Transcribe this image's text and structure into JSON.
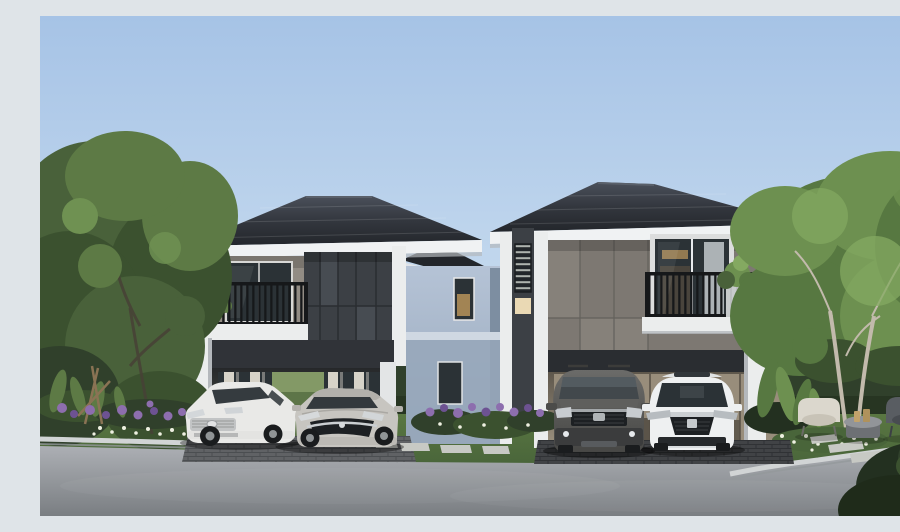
{
  "canvas": {
    "width": 900,
    "height": 500
  },
  "scene": {
    "description": "Daytime architectural rendering of two modern two-storey detached houses with dark hipped tile roofs, charcoal and taupe panelled facades, white trim, balconies with black vertical railings, open double carports with parked cars, landscaped gardens with large trees, hedges, purple and white flower beds, stepping stones, an outdoor seating area with armchairs and a side table, and an asphalt road with concrete kerbs in the foreground.",
    "left_house": {
      "name": "left house",
      "features": [
        "dark hipped tile roof",
        "white fascia",
        "balcony with black vertical railing and plant",
        "charcoal wall panels",
        "glass doors with white curtains",
        "double carport",
        "light blue-grey rear wing with lit window"
      ],
      "cars": [
        {
          "name": "white sedan",
          "color_key": "car_white"
        },
        {
          "name": "silver sedan",
          "color_key": "car_silver"
        }
      ]
    },
    "right_house": {
      "name": "right house",
      "features": [
        "dark hipped tile roof",
        "white fascia",
        "taupe wall panels",
        "large upper window with juliet balcony and potted plant",
        "louvred vent strip with lit panel",
        "double carport with glazed living room behind"
      ],
      "cars": [
        {
          "name": "dark grey suv",
          "color_key": "suv_top"
        },
        {
          "name": "white sedan",
          "color_key": "car_white2"
        }
      ]
    },
    "landscape": {
      "left": [
        "large green tree",
        "clipped hedge",
        "purple flower bed",
        "white ground flowers",
        "staked sapling",
        "tropical foliage"
      ],
      "middle": [
        "purple flower bed between houses",
        "lawn with stepping stones"
      ],
      "right": [
        "large light-green tree with pale trunks",
        "hedge",
        "tropical plants",
        "white flower bed",
        "stepping stone path",
        "dark corner shrub"
      ],
      "background": [
        "neighbouring house rooftops"
      ]
    },
    "furniture": {
      "items": [
        "cream armchair",
        "round side table with candles",
        "dark grey armchair"
      ]
    },
    "road": {
      "type": "asphalt street with concrete kerbs and brick paver driveway aprons"
    }
  },
  "colors": {
    "sky_top": "#a6c3e6",
    "sky_mid": "#c4d9ee",
    "sky_horizon": "#eef2f5",
    "roof_dark": "#23262b",
    "roof_mid": "#33373e",
    "roof_light": "#4a505a",
    "fascia": "#f0f2f3",
    "fascia_shadow": "#b4b8bc",
    "taupe": "#928c84",
    "taupe_dark": "#7d7872",
    "taupe_panel": "#86817a",
    "charcoal": "#3c4045",
    "charcoal_light": "#474c52",
    "charcoal_dark": "#2a2d31",
    "header_dark": "#303338",
    "white_trim": "#ebeded",
    "bluegray_light": "#b5c3d6",
    "bluegray": "#97a7ba",
    "bluegray_dark": "#7d8ea1",
    "glass_dark": "#2b3236",
    "glass_frame": "#dcdddd",
    "curtain": "#d7d3c8",
    "glass_court": "#5d7548",
    "interior_warm": "#988d7b",
    "interior_art": "#c2b399",
    "interior_dark": "#4c463d",
    "interior_glow": "#c0985c",
    "lit_panel": "#ead9b4",
    "railing": "#16181a",
    "hedge": "#30402b",
    "hedge_dark": "#233020",
    "tree_dark": "#3b512f",
    "tree_mid": "#49613a",
    "tree_light": "#5d7a45",
    "tree_bright": "#6f9152",
    "tree2_mid": "#577841",
    "tree2_light": "#6d9050",
    "tree2_bright": "#84a961",
    "trunk_light": "#c2baac",
    "trunk_dark": "#474136",
    "grass": "#5a7742",
    "grass_dark": "#49653a",
    "flower_purple": "#8d6eae",
    "flower_purple_dark": "#6d5292",
    "flower_white": "#eef0e1",
    "road_top": "#adb0b5",
    "road_bottom": "#7a7e82",
    "curb": "#d1d4d5",
    "curb_shadow": "#93989b",
    "paver": "#54575a",
    "paver_dark": "#3e4144",
    "stone": "#c7c9c4",
    "car_white": "#e9e9e7",
    "car_white2": "#eef0f1",
    "car_silver": "#c7c5c0",
    "suv_top": "#6b6b69",
    "suv_bottom": "#474745",
    "wheel": "#1a1c1e",
    "rim": "#909496",
    "chrome": "#cbcfd2",
    "grille": "#1d2023",
    "furn_cream": "#dbd7cd",
    "furn_cream_seat": "#c8c3b7",
    "furn_dark": "#595d62",
    "furn_dark_seat": "#484c51",
    "table_body": "#6d7074",
    "table_top": "#929599",
    "candle": "#c2a36b",
    "bg_roof": "#62686f",
    "bg_wall": "#d7d9db",
    "pot": "#c8cbcc",
    "cp_top": "#26282a",
    "cp_bottom": "#565b50",
    "cp2_top": "#5e574c",
    "cp2_bottom": "#9a8f7d"
  }
}
